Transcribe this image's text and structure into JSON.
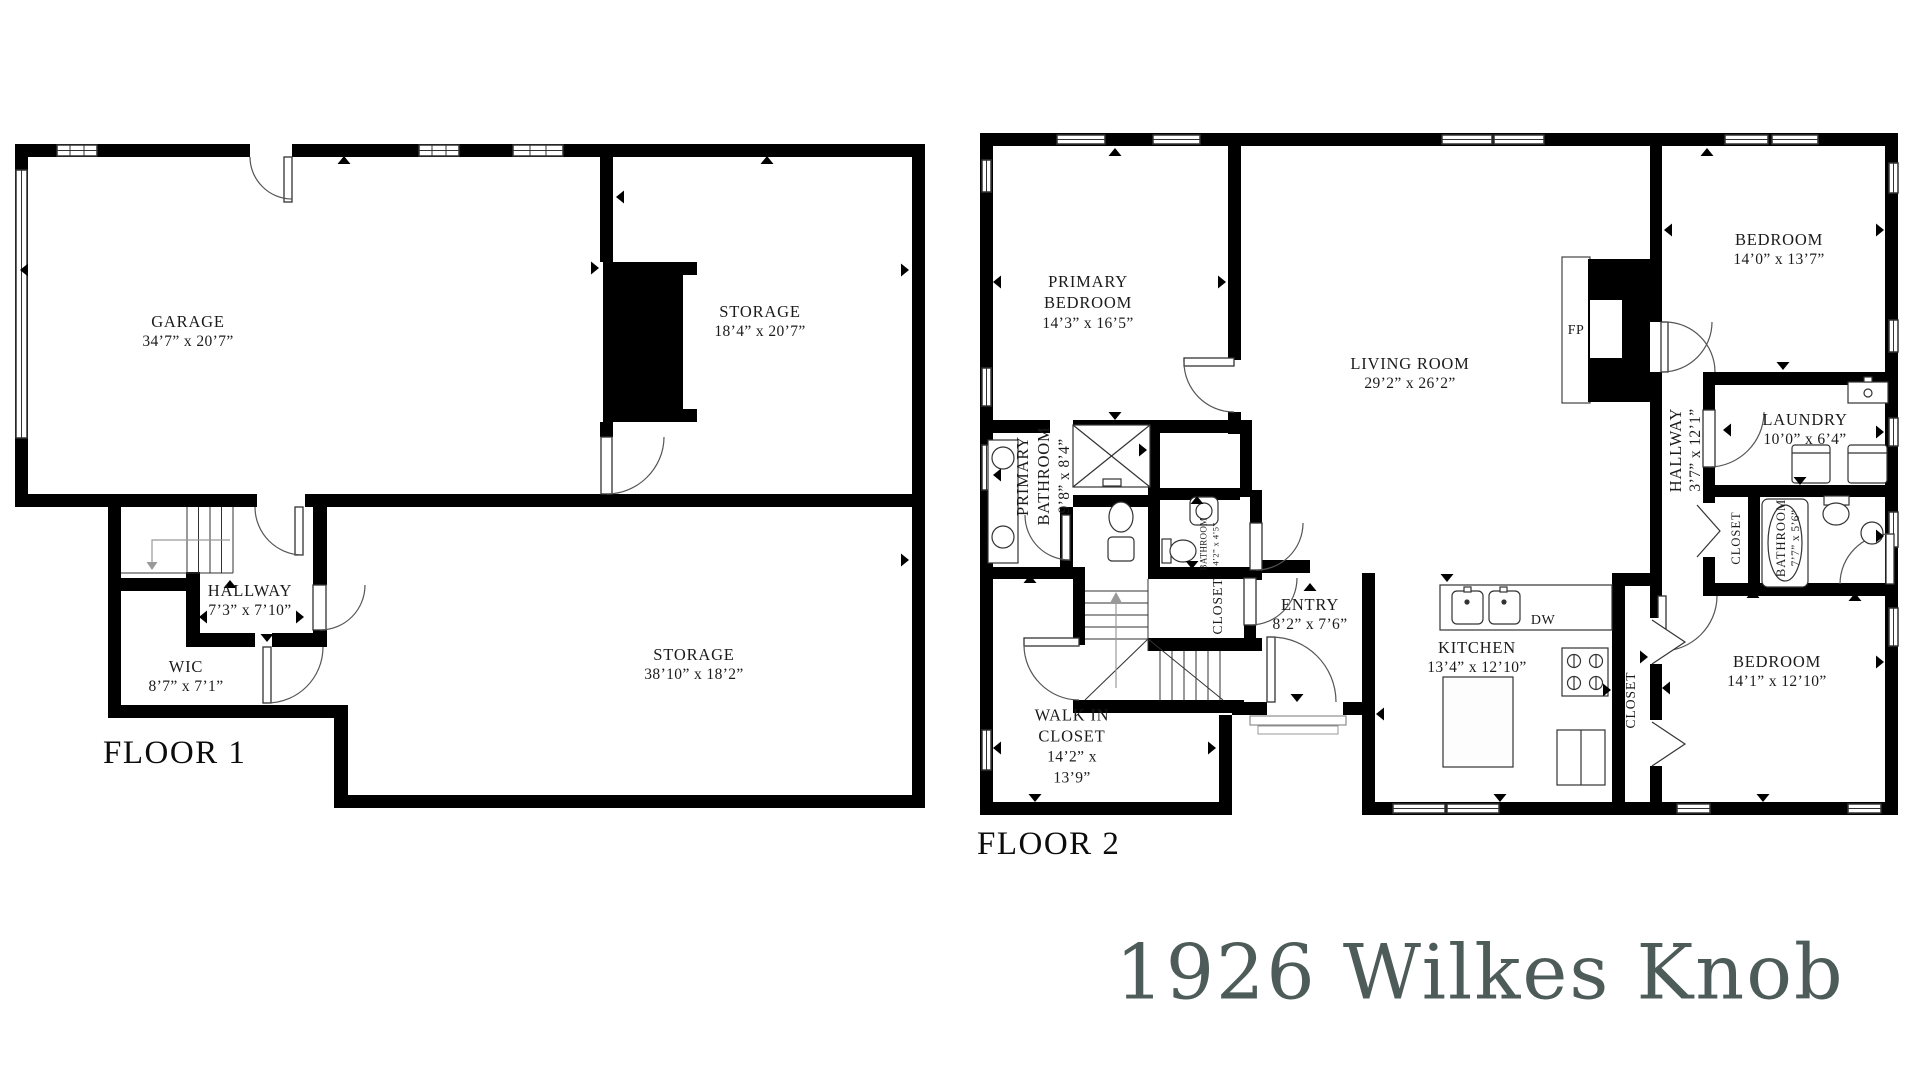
{
  "title": "1926 Wilkes Knob",
  "title_color": "#4d5c58",
  "wall_color": "#000000",
  "floor1": {
    "label": "FLOOR 1",
    "rooms": [
      {
        "name": "GARAGE",
        "dims": "34’7” x 20’7”"
      },
      {
        "name": "STORAGE",
        "dims": "18’4” x 20’7”"
      },
      {
        "name": "HALLWAY",
        "dims": "7’3” x 7’10”"
      },
      {
        "name": "WIC",
        "dims": "8’7” x 7’1”"
      },
      {
        "name": "STORAGE",
        "dims": "38’10” x 18’2”"
      }
    ]
  },
  "floor2": {
    "label": "FLOOR 2",
    "rooms": [
      {
        "name": "PRIMARY BEDROOM",
        "dims": "14’3” x 16’5”"
      },
      {
        "name": "LIVING ROOM",
        "dims": "29’2” x 26’2”"
      },
      {
        "name": "BEDROOM",
        "dims": "14’0” x 13’7”"
      },
      {
        "name": "PRIMARY BATHROOM",
        "dims": "9’8” x 8’4”"
      },
      {
        "name": "BATHROOM",
        "dims": "4’2” x 4’5”"
      },
      {
        "name": "CLOSET",
        "dims": ""
      },
      {
        "name": "ENTRY",
        "dims": "8’2” x 7’6”"
      },
      {
        "name": "WALK IN CLOSET",
        "dims": "14’2” x 13’9”"
      },
      {
        "name": "KITCHEN",
        "dims": "13’4” x 12’10”"
      },
      {
        "name": "HALLWAY",
        "dims": "3’7” x 12’1”"
      },
      {
        "name": "LAUNDRY",
        "dims": "10’0” x 6’4”"
      },
      {
        "name": "CLOSET",
        "dims": ""
      },
      {
        "name": "BATHROOM",
        "dims": "7’7” x 5’6”"
      },
      {
        "name": "CLOSET",
        "dims": ""
      },
      {
        "name": "BEDROOM",
        "dims": "14’1” x 12’10”"
      }
    ],
    "annotations": {
      "dishwasher": "DW",
      "fireplace": "FP"
    }
  }
}
